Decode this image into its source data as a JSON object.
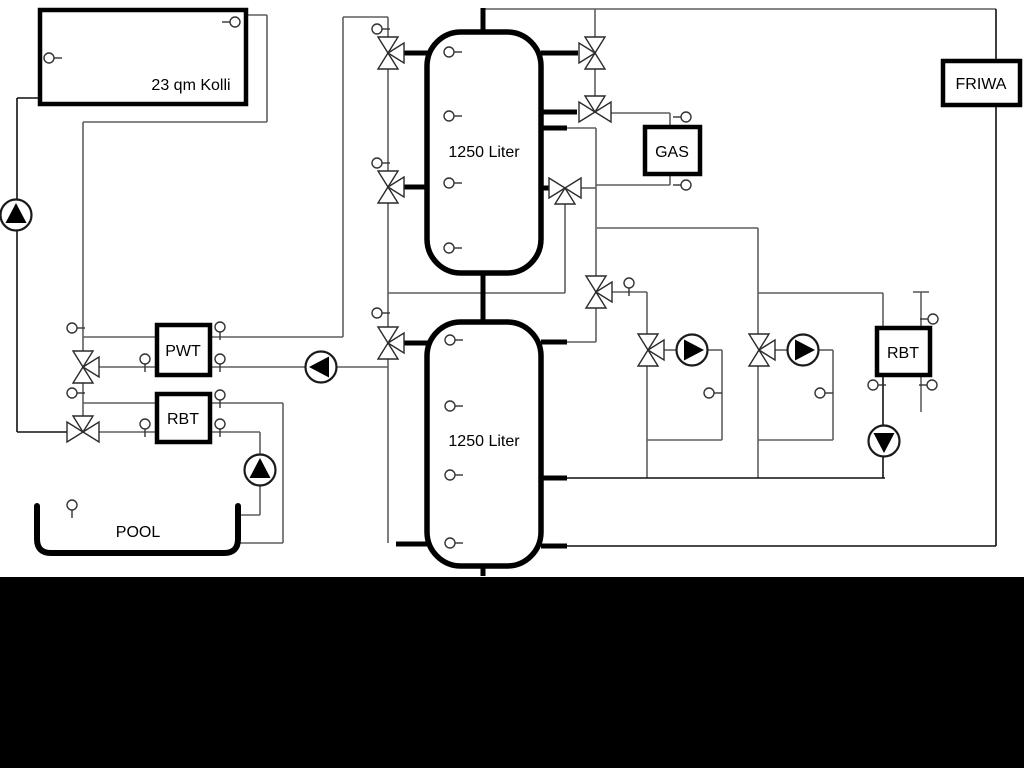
{
  "diagram": {
    "colors": {
      "background": "#ffffff",
      "letterbox": "#000000",
      "pipe": "#5f5f5f",
      "pipe_dark": "#111111",
      "component_stroke": "#000000"
    },
    "labels": {
      "collector": "23 qm Kolli",
      "upper_tank": "1250 Liter",
      "lower_tank": "1250 Liter",
      "pwt": "PWT",
      "rbt_left": "RBT",
      "rbt_right": "RBT",
      "gas": "GAS",
      "friwa": "FRIWA",
      "pool": "POOL"
    }
  }
}
